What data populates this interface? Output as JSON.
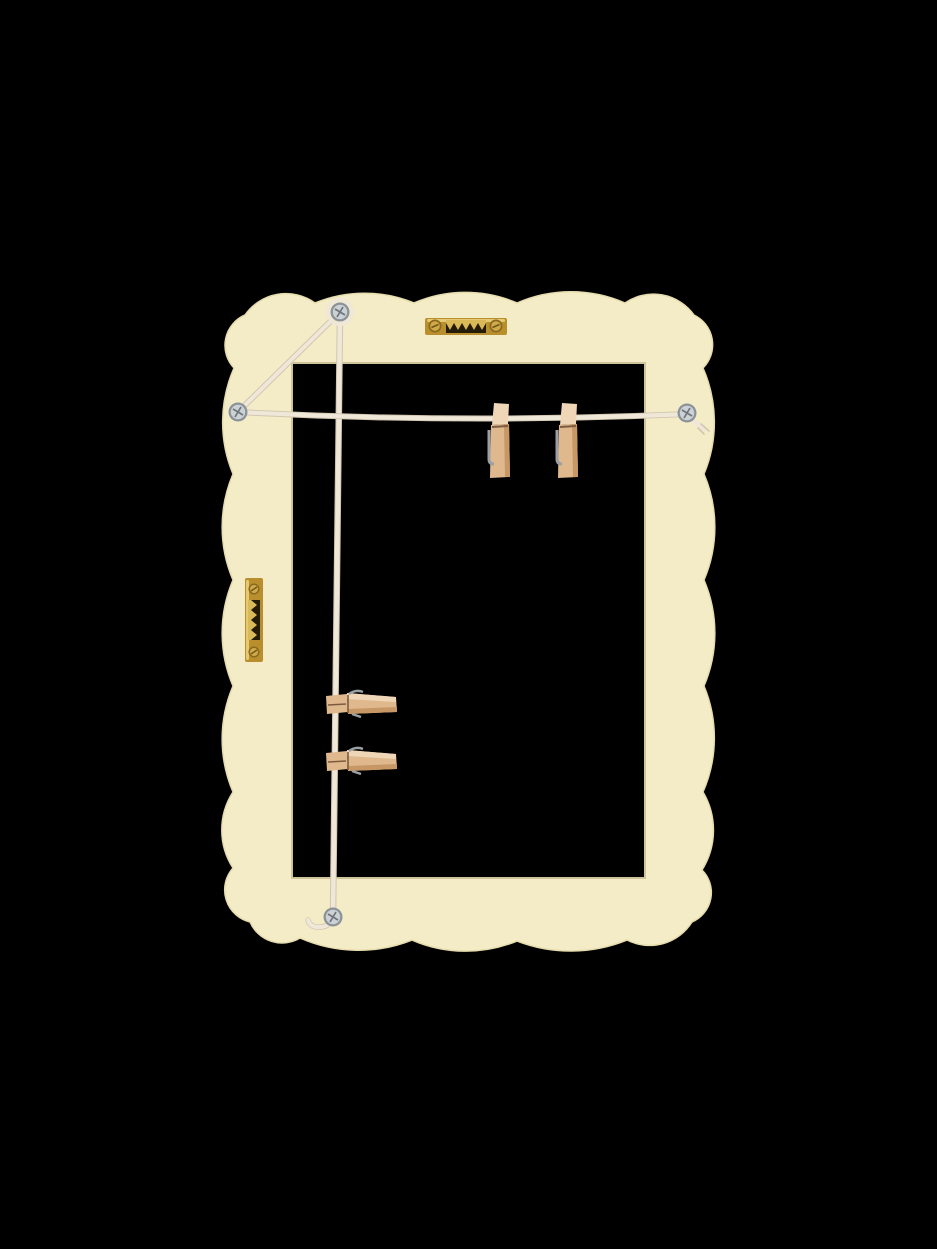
{
  "scene": {
    "alt": "Back view of a cream scalloped rectangular photo frame hung with twine strings, four wooden clothespins, two brass sawtooth hangers and four silver screws, on a black background",
    "objects": {
      "frame": "scalloped-frame-back",
      "top_hanger": "brass-sawtooth-hanger-horizontal",
      "side_hanger": "brass-sawtooth-hanger-vertical",
      "screws": [
        "top-left-screw",
        "left-screw",
        "right-screw",
        "bottom-screw"
      ],
      "strings": [
        "diagonal-string",
        "vertical-string",
        "horizontal-string",
        "string-tail-right",
        "string-tail-bottom"
      ],
      "clothespins": [
        "hanging-pin-left",
        "hanging-pin-right",
        "clipped-pin-upper",
        "clipped-pin-lower"
      ]
    }
  },
  "colors": {
    "background": "#000000",
    "frame": "#f3ecc6",
    "frame_edge": "#e6dcae",
    "hole_edge": "#cfc499",
    "brass": "#b98f2e",
    "brass_light": "#ecd47f",
    "brass_mid": "#d9b958",
    "brass_dark": "#6e5618",
    "brass_slot": "#241b06",
    "brass_screw": "#cfa94a",
    "brass_screw_rim": "#8a681c",
    "silver": "#ccd1d5",
    "silver_rim": "#8b9399",
    "silver_cross": "#6d757b",
    "string": "#efe7d8",
    "string_shade": "#d3c6b0",
    "wood": "#e0b88d",
    "wood_light": "#eed6b6",
    "wood_dark": "#c79765",
    "wood_seam": "#7c5c3e",
    "spring": "#9aa0a4"
  }
}
